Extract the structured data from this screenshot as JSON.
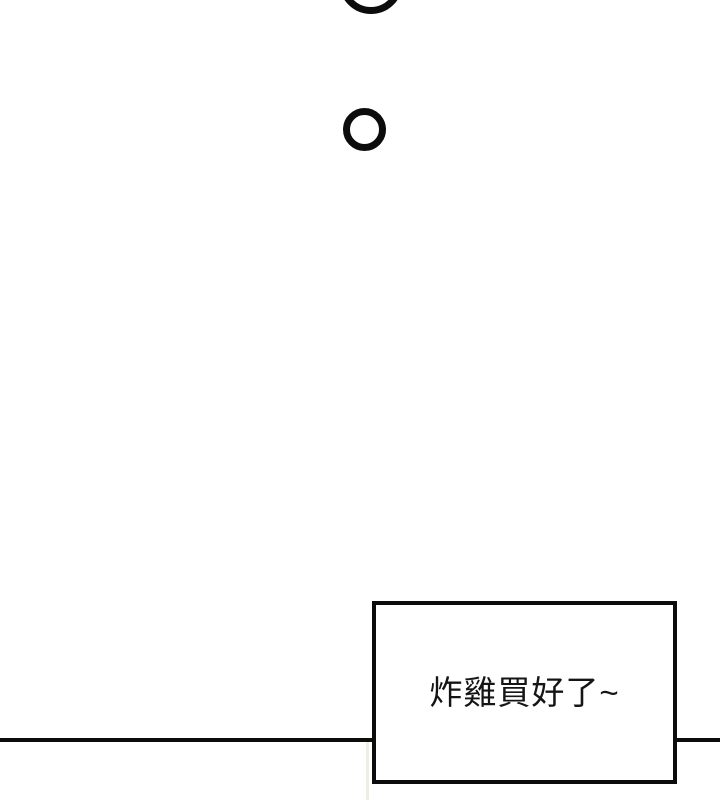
{
  "page": {
    "background_color": "#ffffff",
    "ink_color": "#0c0c0c"
  },
  "speech_box": {
    "text": "炸雞買好了~",
    "text_color": "#151515",
    "border_color": "#0c0c0c",
    "background_color": "#ffffff"
  },
  "decorations": {
    "bubble_trail": {
      "circle_count": 2,
      "stroke_color": "#0c0c0c",
      "description": "thought-bubble trail rings, top one clipped by image edge"
    },
    "panel_divider": {
      "color": "#0c0c0c"
    },
    "seam_line": {
      "color": "#f0ede4"
    }
  }
}
